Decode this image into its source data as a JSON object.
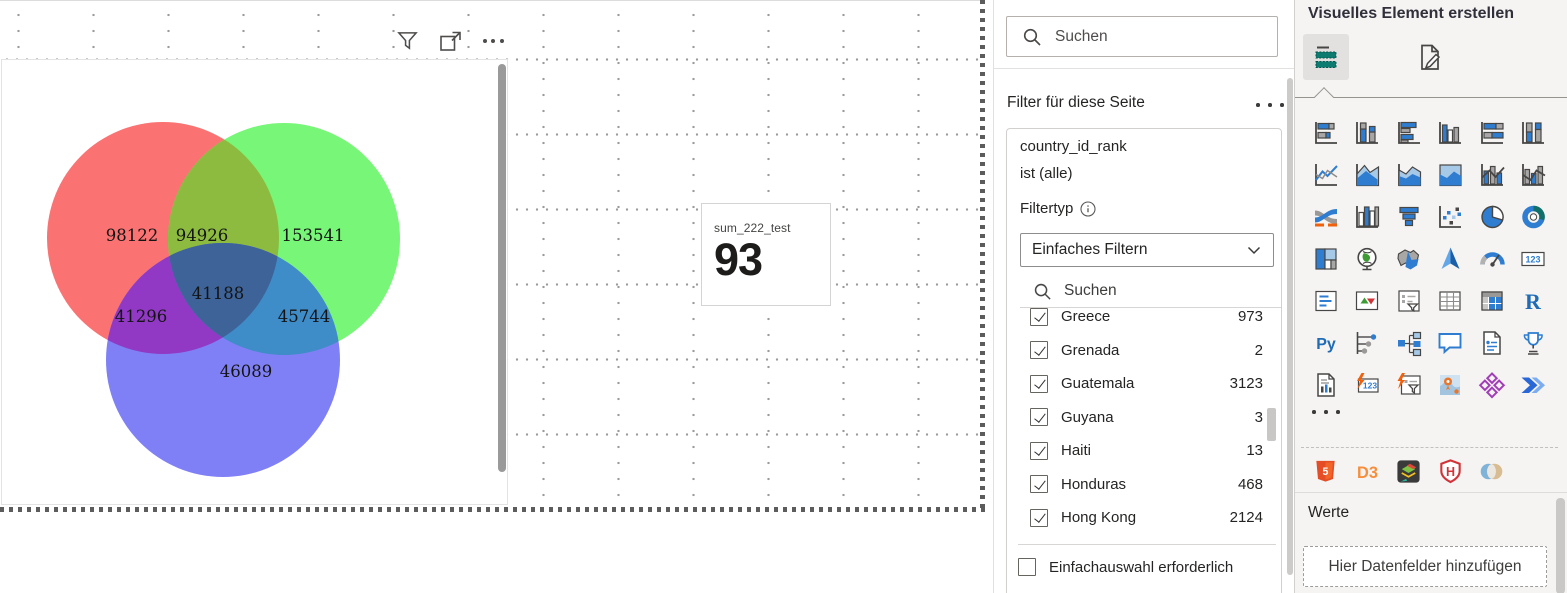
{
  "canvas": {
    "visual_toolbar": {
      "icons": [
        "filter-icon",
        "focus-mode-icon",
        "more-options-icon"
      ]
    },
    "venn_visual": {
      "chart_data": {
        "type": "venn",
        "regions": [
          {
            "region": "red-only",
            "value": "98122"
          },
          {
            "region": "red-green-overlap",
            "value": "94926"
          },
          {
            "region": "green-only",
            "value": "153541"
          },
          {
            "region": "center-all-three",
            "value": "41188"
          },
          {
            "region": "red-blue-overlap",
            "value": "41296"
          },
          {
            "region": "green-blue-overlap",
            "value": "45744"
          },
          {
            "region": "blue-only",
            "value": "46089"
          }
        ],
        "colors": {
          "red": "#FA7272",
          "green": "#77F677",
          "blue": "#8080F6",
          "red_green": "#8CBB40",
          "red_blue": "#9139C4",
          "green_blue": "#3E8CC8",
          "center": "#3D6399"
        }
      }
    },
    "card_visual": {
      "label": "sum_222_test",
      "value": "93"
    }
  },
  "filter_pane": {
    "search_placeholder": "Suchen",
    "section_title": "Filter für diese Seite",
    "filter_card": {
      "field": "country_id_rank",
      "condition": "ist (alle)",
      "filter_type_label": "Filtertyp",
      "filter_type_value": "Einfaches Filtern",
      "search_placeholder": "Suchen",
      "items": [
        {
          "label": "Greece",
          "value": "973",
          "checked": true
        },
        {
          "label": "Grenada",
          "value": "2",
          "checked": true
        },
        {
          "label": "Guatemala",
          "value": "3123",
          "checked": true
        },
        {
          "label": "Guyana",
          "value": "3",
          "checked": true
        },
        {
          "label": "Haiti",
          "value": "13",
          "checked": true
        },
        {
          "label": "Honduras",
          "value": "468",
          "checked": true
        },
        {
          "label": "Hong Kong",
          "value": "2124",
          "checked": true
        }
      ],
      "require_single_label": "Einfachauswahl erforderlich"
    }
  },
  "viz_pane": {
    "title": "Visuelles Element erstellen",
    "tabs": [
      {
        "name": "build-visual",
        "selected": true
      },
      {
        "name": "format-visual",
        "selected": false
      }
    ],
    "gallery": [
      "stacked-bar-chart",
      "stacked-column-chart",
      "clustered-bar-chart",
      "clustered-column-chart",
      "stacked-bar-100-chart",
      "stacked-column-100-chart",
      "line-chart",
      "area-chart",
      "stacked-area-chart",
      "stacked-area-100-chart",
      "line-stacked-column-chart",
      "line-clustered-column-chart",
      "ribbon-chart",
      "waterfall-chart",
      "funnel-chart",
      "scatter-chart",
      "pie-chart",
      "donut-chart",
      "treemap",
      "map",
      "filled-map",
      "azure-map",
      "gauge",
      "card",
      "multi-row-card",
      "kpi",
      "slicer",
      "table",
      "matrix",
      "r-script",
      "python-visual",
      "key-influencers",
      "decomposition-tree",
      "q-and-a",
      "smart-narrative",
      "metrics",
      "paginated-report",
      "card-new",
      "slicer-new",
      "arcgis-map",
      "custom-visual-diamond",
      "power-automate"
    ],
    "custom_visuals": [
      "html5-visual",
      "d3-visual",
      "map-layers-visual",
      "h-shield-visual",
      "overlap-circles-visual"
    ],
    "values_section": {
      "title": "Werte",
      "field_well_placeholder": "Hier Datenfelder hinzufügen"
    }
  }
}
